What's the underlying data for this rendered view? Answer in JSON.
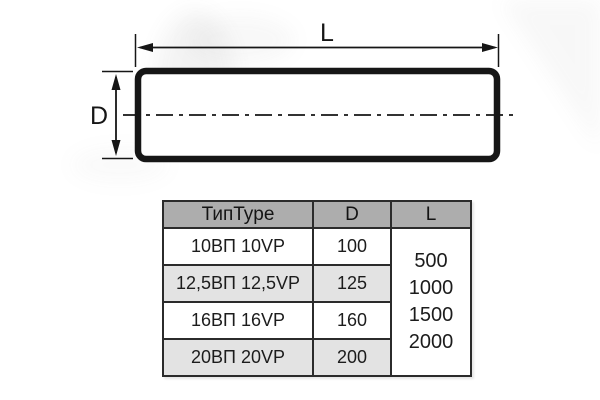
{
  "diagram": {
    "length_label": "L",
    "diameter_label": "D"
  },
  "table": {
    "headers": [
      "ТипType",
      "D",
      "L"
    ],
    "rows": [
      {
        "type": "10ВП 10VP",
        "d": "100"
      },
      {
        "type": "12,5ВП 12,5VP",
        "d": "125"
      },
      {
        "type": "16ВП 16VP",
        "d": "160"
      },
      {
        "type": "20ВП 20VP",
        "d": "200"
      }
    ],
    "lengths": [
      "500",
      "1000",
      "1500",
      "2000"
    ]
  },
  "colors": {
    "header_bg": "#adadad",
    "row_alt_bg": "#e3e3e3",
    "table_border": "#2b2b2b",
    "drawing_line": "#161616",
    "background": "#ffffff"
  }
}
